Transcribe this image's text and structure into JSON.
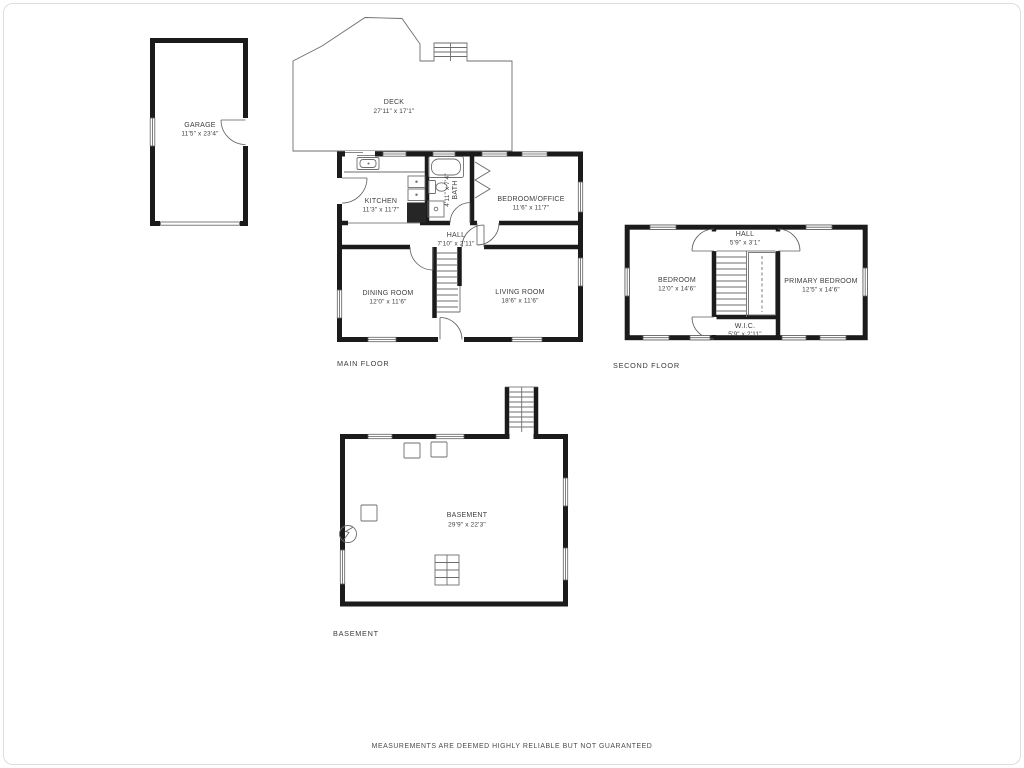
{
  "disclaimer": "MEASUREMENTS ARE DEEMED HIGHLY RELIABLE BUT NOT GUARANTEED",
  "floor_labels": {
    "main": "MAIN FLOOR",
    "second": "SECOND FLOOR",
    "basement": "BASEMENT"
  },
  "rooms": {
    "garage": {
      "name": "GARAGE",
      "dims": "11'5\" x 23'4\""
    },
    "deck": {
      "name": "DECK",
      "dims": "27'11\" x 17'1\""
    },
    "kitchen": {
      "name": "KITCHEN",
      "dims": "11'3\" x 11'7\""
    },
    "bath": {
      "name": "BATH",
      "dims": "4'11\" x 7'4\""
    },
    "bedroom_office": {
      "name": "BEDROOM/OFFICE",
      "dims": "11'6\" x 11'7\""
    },
    "hall_main": {
      "name": "HALL",
      "dims": "7'10\" x 2'11\""
    },
    "dining": {
      "name": "DINING ROOM",
      "dims": "12'0\" x 11'6\""
    },
    "living": {
      "name": "LIVING ROOM",
      "dims": "18'6\" x 11'6\""
    },
    "bedroom2": {
      "name": "BEDROOM",
      "dims": "12'0\" x 14'6\""
    },
    "hall_second": {
      "name": "HALL",
      "dims": "5'9\" x 3'1\""
    },
    "primary": {
      "name": "PRIMARY BEDROOM",
      "dims": "12'5\" x 14'6\""
    },
    "wic": {
      "name": "W.I.C.",
      "dims": "5'9\" x 2'11\""
    },
    "basement": {
      "name": "BASEMENT",
      "dims": "29'9\" x 22'3\""
    }
  },
  "colors": {
    "wall": "#1b1b1b",
    "line": "#6e6e6e",
    "text": "#3d3d3d"
  }
}
